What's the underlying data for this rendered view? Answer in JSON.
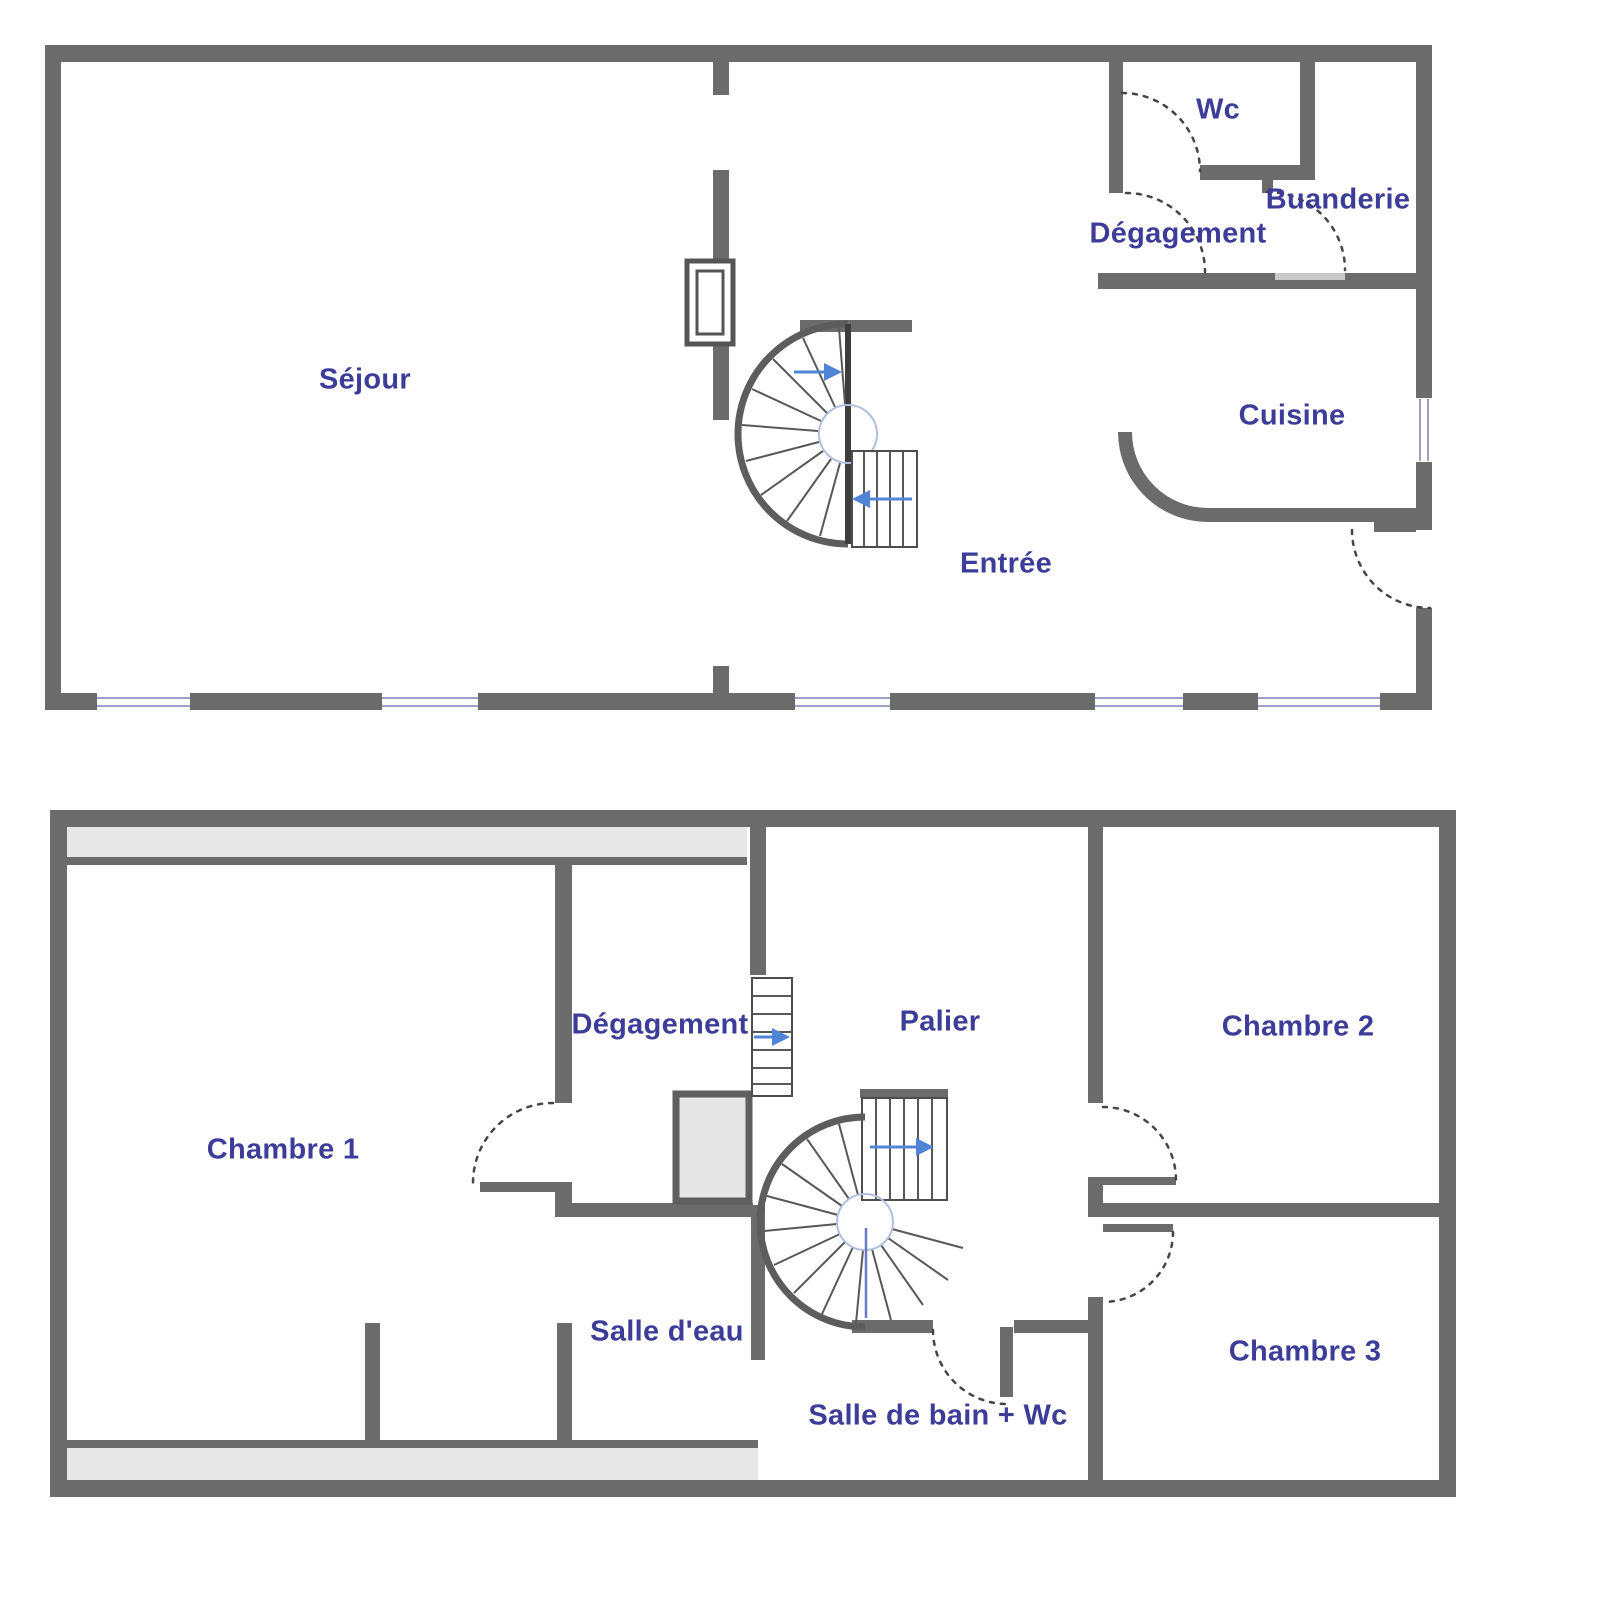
{
  "colors": {
    "wall": "#6b6b6b",
    "label": "#3d3d99",
    "arrow": "#4f84d6",
    "window": "#9aa0c6",
    "low_ceiling_band": "#e7e7e7",
    "closet_fill": "#e6e6e6",
    "threshold": "#c9c9c9",
    "door_swing": "#454545",
    "stair_accent": "#b0bedf"
  },
  "floors": [
    {
      "id": "ground-floor",
      "rooms": [
        {
          "name": "Séjour"
        },
        {
          "name": "Wc"
        },
        {
          "name": "Dégagement"
        },
        {
          "name": "Buanderie"
        },
        {
          "name": "Cuisine"
        },
        {
          "name": "Entrée"
        }
      ]
    },
    {
      "id": "first-floor",
      "rooms": [
        {
          "name": "Dégagement"
        },
        {
          "name": "Palier"
        },
        {
          "name": "Chambre 2"
        },
        {
          "name": "Chambre 1"
        },
        {
          "name": "Salle d'eau"
        },
        {
          "name": "Salle de bain + Wc"
        },
        {
          "name": "Chambre 3"
        }
      ]
    }
  ]
}
